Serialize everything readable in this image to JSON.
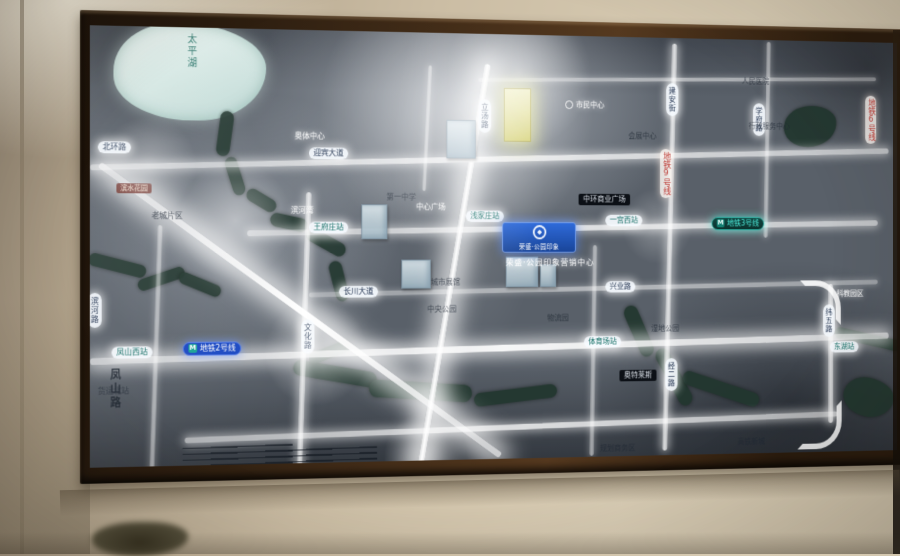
{
  "photo": {
    "wall_color": "#cbbda4",
    "frame_color": "#3a2715"
  },
  "map": {
    "ground_color": "#596069",
    "road_color": "#ffffff",
    "water_color": "#20362e",
    "lake_color": "#bcd8d4",
    "accent_teal": "#45e6d6",
    "accent_blue": "#1747c8",
    "accent_red": "#c23a34",
    "accent_yellow": "#e9e98e",
    "lake_label": "太平湖",
    "badge": {
      "title": "荣盛·公园印象",
      "caption": "荣盛·公园印象营销中心"
    },
    "roads": [
      {
        "x": 410,
        "y": 42,
        "w": 455,
        "h": 4,
        "r": -1,
        "g": 0
      },
      {
        "x": 0,
        "y": 127,
        "w": 880,
        "h": 6,
        "r": -1.6,
        "g": 1
      },
      {
        "x": 162,
        "y": 199,
        "w": 705,
        "h": 6,
        "r": -1,
        "g": 1
      },
      {
        "x": 227,
        "y": 263,
        "w": 640,
        "h": 5,
        "r": -1,
        "g": 0
      },
      {
        "x": 0,
        "y": 324,
        "w": 880,
        "h": 7,
        "r": -1.2,
        "g": 2
      },
      {
        "x": 97,
        "y": 407,
        "w": 722,
        "h": 6,
        "r": -1.2,
        "g": 1
      },
      {
        "x": 65,
        "y": 200,
        "w": 5,
        "h": 252,
        "r": 2,
        "g": 0
      },
      {
        "x": 219,
        "y": 166,
        "w": 6,
        "h": 290,
        "r": 2,
        "g": 1
      },
      {
        "x": 379,
        "y": 28,
        "w": 7,
        "h": 436,
        "r": 10,
        "g": 3
      },
      {
        "x": 535,
        "y": 220,
        "w": 5,
        "h": 222,
        "r": 1,
        "g": 0
      },
      {
        "x": 621,
        "y": 6,
        "w": 6,
        "h": 432,
        "r": 1.5,
        "g": 1
      },
      {
        "x": 734,
        "y": 2,
        "w": 5,
        "h": 210,
        "r": 1,
        "g": 0
      },
      {
        "x": 808,
        "y": 262,
        "w": 6,
        "h": 150,
        "r": 0,
        "g": 1
      },
      {
        "x": 352,
        "y": 34,
        "w": 4,
        "h": 130,
        "r": 3,
        "g": 0
      },
      {
        "x": -38,
        "y": 286,
        "w": 520,
        "h": 7,
        "r": 35.3,
        "g": 3
      }
    ],
    "curves": [
      {
        "x": 775,
        "y": 258,
        "s": 36,
        "c": "tr"
      },
      {
        "x": 772,
        "y": 388,
        "s": 40,
        "c": "br"
      }
    ],
    "water": [
      {
        "x": 132,
        "y": 84,
        "w": 14,
        "h": 46,
        "r": 8
      },
      {
        "x": 143,
        "y": 130,
        "w": 13,
        "h": 40,
        "r": -18
      },
      {
        "x": 160,
        "y": 168,
        "w": 34,
        "h": 13,
        "r": 30
      },
      {
        "x": 186,
        "y": 190,
        "w": 40,
        "h": 14,
        "r": 12
      },
      {
        "x": 222,
        "y": 210,
        "w": 46,
        "h": 14,
        "r": 28
      },
      {
        "x": 252,
        "y": 236,
        "w": 14,
        "h": 42,
        "r": -15
      },
      {
        "x": -2,
        "y": 234,
        "w": 60,
        "h": 13,
        "r": 14
      },
      {
        "x": 48,
        "y": 248,
        "w": 50,
        "h": 12,
        "r": -18
      },
      {
        "x": 90,
        "y": 254,
        "w": 46,
        "h": 12,
        "r": 22
      },
      {
        "x": 210,
        "y": 344,
        "w": 90,
        "h": 16,
        "r": 10
      },
      {
        "x": 291,
        "y": 362,
        "w": 112,
        "h": 18,
        "r": 4
      },
      {
        "x": 405,
        "y": 370,
        "w": 92,
        "h": 14,
        "r": -6
      },
      {
        "x": 226,
        "y": 324,
        "w": 46,
        "h": 12,
        "r": -20
      },
      {
        "x": 581,
        "y": 282,
        "w": 16,
        "h": 58,
        "r": -25
      },
      {
        "x": 621,
        "y": 326,
        "w": 16,
        "h": 68,
        "r": -30
      },
      {
        "x": 637,
        "y": 366,
        "w": 92,
        "h": 15,
        "r": 18
      },
      {
        "x": 815,
        "y": 316,
        "w": 80,
        "h": 12,
        "r": 12
      },
      {
        "x": 756,
        "y": 70,
        "w": 62,
        "h": 44,
        "r": -8,
        "blob": 1
      },
      {
        "x": 826,
        "y": 364,
        "w": 60,
        "h": 42,
        "r": 10,
        "blob": 1
      }
    ],
    "buildings": [
      {
        "x": 375,
        "y": 90,
        "w": 30,
        "h": 38
      },
      {
        "x": 283,
        "y": 178,
        "w": 26,
        "h": 34
      },
      {
        "x": 326,
        "y": 235,
        "w": 30,
        "h": 28
      },
      {
        "x": 440,
        "y": 232,
        "w": 34,
        "h": 30
      },
      {
        "x": 478,
        "y": 240,
        "w": 16,
        "h": 22
      },
      {
        "x": 438,
        "y": 56,
        "w": 28,
        "h": 54,
        "hl": 1
      }
    ],
    "labels": [
      {
        "t": "pillv",
        "text": "立汤路",
        "x": 410,
        "y": 68
      },
      {
        "t": "pillv",
        "text": "建安街",
        "x": 620,
        "y": 48
      },
      {
        "t": "pillv",
        "text": "学府路",
        "x": 720,
        "y": 68
      },
      {
        "t": "pillv",
        "text": "文化路",
        "x": 219,
        "y": 296
      },
      {
        "t": "pillv",
        "text": "滨河路",
        "x": -2,
        "y": 268
      },
      {
        "t": "pillv",
        "text": "经二路",
        "x": 619,
        "y": 340
      },
      {
        "t": "pillv",
        "text": "纬五路",
        "x": 802,
        "y": 284
      },
      {
        "t": "pillh",
        "text": "迎宾大道",
        "x": 227,
        "y": 120
      },
      {
        "t": "pillh",
        "text": "北环路",
        "x": 8,
        "y": 116
      },
      {
        "t": "pillh",
        "text": "长川大道",
        "x": 259,
        "y": 262
      },
      {
        "t": "pillh",
        "text": "兴业路",
        "x": 551,
        "y": 258
      },
      {
        "t": "station",
        "text": "王府庄站",
        "x": 227,
        "y": 196
      },
      {
        "t": "station",
        "text": "浅家庄站",
        "x": 396,
        "y": 184
      },
      {
        "t": "station",
        "text": "一宫西站",
        "x": 551,
        "y": 188
      },
      {
        "t": "station",
        "text": "凤山西站",
        "x": 22,
        "y": 322
      },
      {
        "t": "station",
        "text": "体育场站",
        "x": 527,
        "y": 316
      },
      {
        "t": "station",
        "text": "东湖站",
        "x": 810,
        "y": 324
      },
      {
        "t": "mteal",
        "text": "地铁3号线",
        "x": 672,
        "y": 190
      },
      {
        "t": "mblue",
        "text": "地铁2号线",
        "x": 95,
        "y": 318
      },
      {
        "t": "mredv",
        "text": "地铁9号线",
        "x": 613,
        "y": 118
      },
      {
        "t": "mredv",
        "text": "地铁6号线",
        "x": 852,
        "y": 58
      },
      {
        "t": "black",
        "text": "中环商业广场",
        "x": 521,
        "y": 166
      },
      {
        "t": "black",
        "text": "奥特莱斯",
        "x": 567,
        "y": 352
      },
      {
        "t": "redtag",
        "text": "滨水花园",
        "x": 27,
        "y": 158
      },
      {
        "t": "bigv",
        "text": "凤山路",
        "x": 19,
        "y": 344
      },
      {
        "t": "dark",
        "text": "第一中学",
        "x": 310,
        "y": 166
      },
      {
        "t": "dark",
        "text": "会展中心",
        "x": 577,
        "y": 100
      },
      {
        "t": "dark",
        "text": "人民医院",
        "x": 707,
        "y": 40
      },
      {
        "t": "dark",
        "text": "行政服务中心",
        "x": 715,
        "y": 88
      },
      {
        "t": "dark",
        "text": "物流园",
        "x": 486,
        "y": 292
      },
      {
        "t": "dark",
        "text": "湿地公园",
        "x": 603,
        "y": 304
      },
      {
        "t": "dark",
        "text": "中央公园",
        "x": 354,
        "y": 282
      },
      {
        "t": "dark",
        "text": "老城片区",
        "x": 63,
        "y": 186
      },
      {
        "t": "dark",
        "text": "货运北站",
        "x": 8,
        "y": 362
      },
      {
        "t": "dark",
        "text": "高铁新城",
        "x": 702,
        "y": 426
      },
      {
        "t": "dark",
        "text": "城市展馆",
        "x": 358,
        "y": 254
      },
      {
        "t": "dark",
        "text": "规划商务区",
        "x": 545,
        "y": 430
      },
      {
        "t": "white",
        "text": "奥体中心",
        "x": 212,
        "y": 104
      },
      {
        "t": "white",
        "text": "滨河湾",
        "x": 208,
        "y": 180
      },
      {
        "t": "white",
        "text": "中心广场",
        "x": 342,
        "y": 176
      },
      {
        "t": "white",
        "text": "市民中心",
        "x": 506,
        "y": 68,
        "icon": 1
      },
      {
        "t": "white",
        "text": "科教园区",
        "x": 818,
        "y": 268
      }
    ],
    "hatches": [
      {
        "x": 95,
        "y": 424,
        "w": 115,
        "n": 4
      },
      {
        "x": 205,
        "y": 428,
        "w": 95,
        "n": 4
      }
    ],
    "flares": [
      {
        "x": 388,
        "y": 80,
        "r": 150,
        "a": 0.55
      },
      {
        "x": 455,
        "y": 40,
        "r": 80,
        "a": 0.5
      },
      {
        "x": 150,
        "y": 195,
        "r": 60,
        "a": 0.45
      },
      {
        "x": 60,
        "y": 140,
        "r": 50,
        "a": 0.4
      },
      {
        "x": 235,
        "y": 330,
        "r": 55,
        "a": 0.5
      },
      {
        "x": 352,
        "y": 438,
        "r": 45,
        "a": 0.45
      },
      {
        "x": 610,
        "y": 200,
        "r": 40,
        "a": 0.3
      }
    ]
  }
}
